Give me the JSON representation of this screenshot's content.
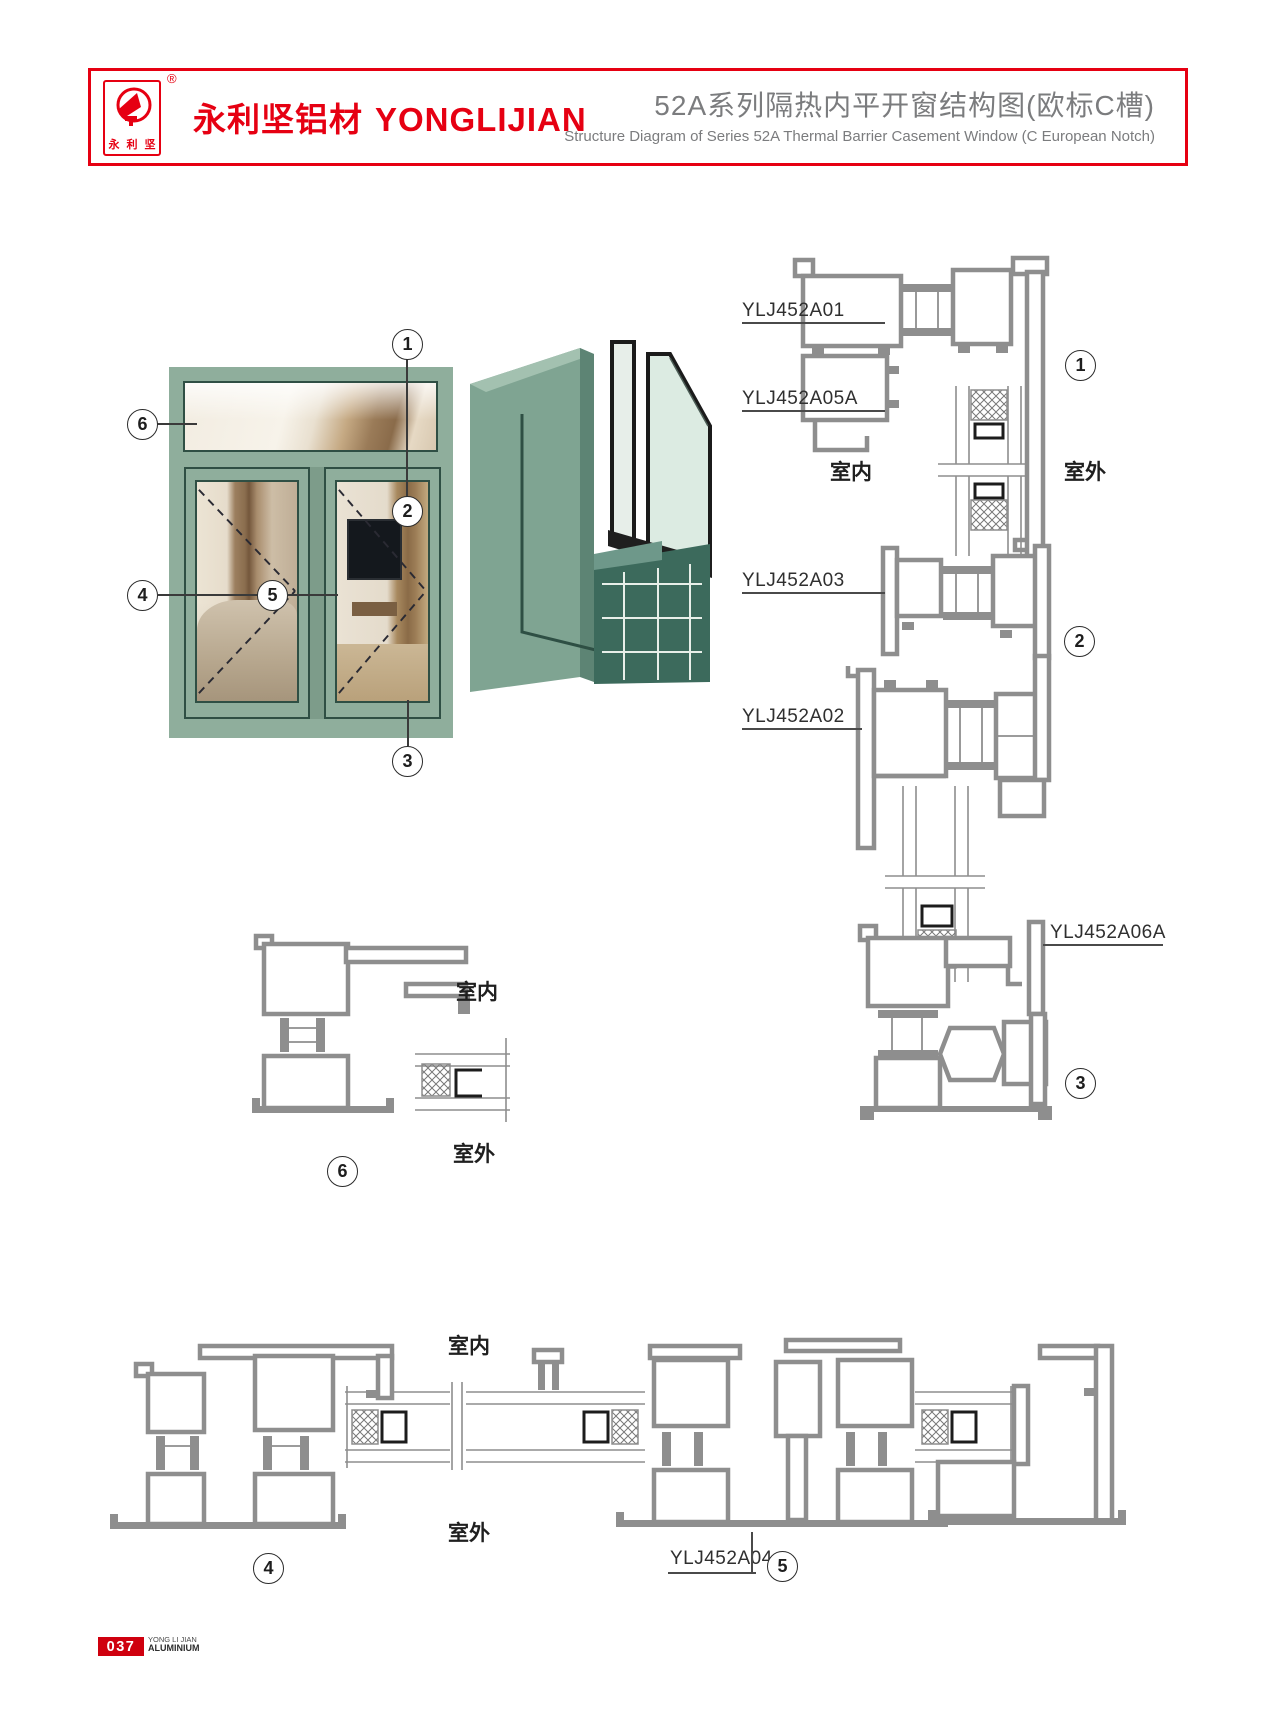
{
  "header": {
    "brand_cn": "永利坚铝材",
    "brand_en": "YONGLIJIAN",
    "logo_chars": [
      "永",
      "利",
      "坚"
    ],
    "registered_mark": "®",
    "title_cn": "52A系列隔热内平开窗结构图(欧标C槽)",
    "title_en": "Structure Diagram of Series 52A Thermal Barrier Casement Window  (C European Notch)"
  },
  "labels": {
    "indoor": "室内",
    "outdoor": "室外"
  },
  "callouts": {
    "n1": "1",
    "n2": "2",
    "n3": "3",
    "n4": "4",
    "n5": "5",
    "n6": "6"
  },
  "profile_codes": {
    "head_frame": "YLJ452A01",
    "transom_sash": "YLJ452A05A",
    "transom_mullion": "YLJ452A03",
    "casement_frame": "YLJ452A02",
    "sash_bottom": "YLJ452A06A",
    "mullion": "YLJ452A04"
  },
  "footer": {
    "page_no": "037",
    "line1": "YONG LI JIAN",
    "line2": "ALUMINIUM"
  },
  "colors": {
    "accent_red": "#e60012",
    "window_green": "#8fae9c",
    "render_green": "#7fa492",
    "drawing_gray": "#8e8e8e",
    "title_gray": "#7b7c7e"
  }
}
